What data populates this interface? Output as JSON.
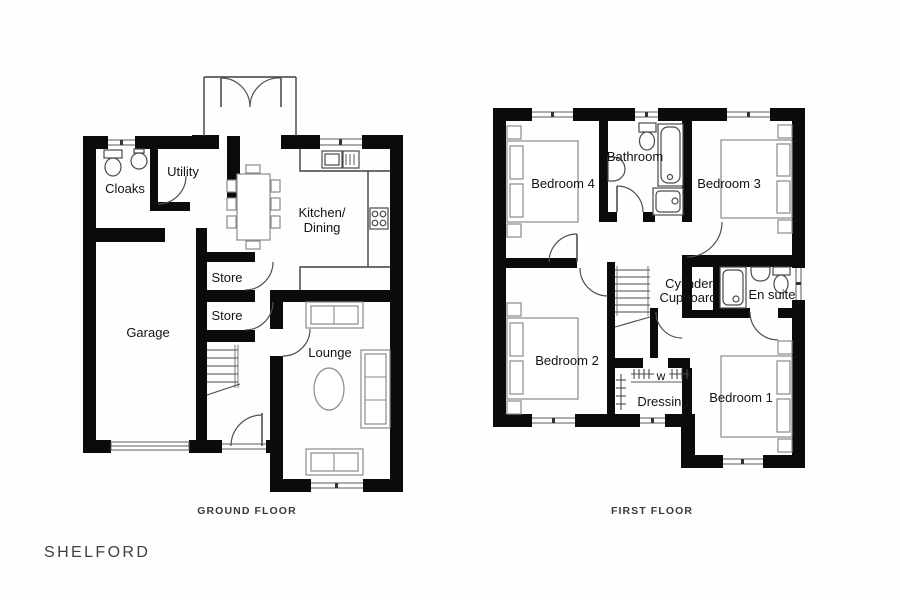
{
  "plan": {
    "name": "SHELFORD"
  },
  "ground_floor": {
    "caption": "GROUND FLOOR",
    "labels": {
      "cloaks": "Cloaks",
      "utility": "Utility",
      "kitchen1": "Kitchen/",
      "kitchen2": "Dining",
      "store_top": "Store",
      "store_bottom": "Store",
      "garage": "Garage",
      "lounge": "Lounge"
    }
  },
  "first_floor": {
    "caption": "FIRST FLOOR",
    "labels": {
      "bedroom4": "Bedroom 4",
      "bathroom": "Bathroom",
      "bedroom3": "Bedroom 3",
      "cylinder1": "Cylinder",
      "cylinder2": "Cupboard",
      "ensuite": "En suite",
      "bedroom2": "Bedroom 2",
      "wardrobe": "w",
      "dressing": "Dressing",
      "bedroom1": "Bedroom 1"
    }
  },
  "colors": {
    "background": "#ffffff",
    "wall": "#0b0b0b",
    "line": "#4f4f4f",
    "furniture": "#8a8a8a",
    "text": "#131313",
    "caption": "#3a3a3a"
  }
}
